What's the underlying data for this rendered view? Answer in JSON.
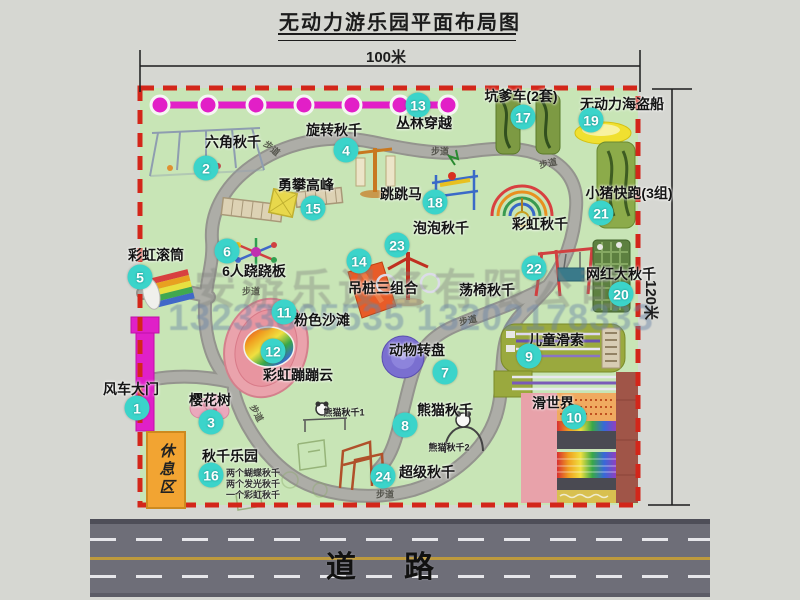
{
  "title": "无动力游乐园平面布局图",
  "dim_width": "100米",
  "dim_height": "120米",
  "road_label": "道路",
  "rest_area_label": "休息区",
  "path_label": "步道",
  "rainbow_swing_label": "彩虹秋千",
  "watermark": {
    "company": "安游乐设备有限公司",
    "phone": "13233805535 13202178333"
  },
  "attractions": [
    {
      "num": "1",
      "label": "风车大门"
    },
    {
      "num": "2",
      "label": "六角秋千"
    },
    {
      "num": "3",
      "label": "樱花树"
    },
    {
      "num": "4",
      "label": "旋转秋千"
    },
    {
      "num": "5",
      "label": "彩虹滚筒"
    },
    {
      "num": "6",
      "label": "6人跷跷板"
    },
    {
      "num": "7",
      "label": "动物转盘"
    },
    {
      "num": "8",
      "label": "熊猫秋千",
      "sub1": "熊猫秋千1",
      "sub2": "熊猫秋千2"
    },
    {
      "num": "9",
      "label": "儿童滑索"
    },
    {
      "num": "10",
      "label": "滑世界"
    },
    {
      "num": "11",
      "label": "粉色沙滩"
    },
    {
      "num": "12",
      "label": "彩虹蹦蹦云"
    },
    {
      "num": "13",
      "label": "丛林穿越"
    },
    {
      "num": "14",
      "label": "吊桩三组合"
    },
    {
      "num": "15",
      "label": "勇攀高峰"
    },
    {
      "num": "16",
      "label": "秋千乐园",
      "notes": [
        "两个蝴蝶秋千",
        "两个发光秋千",
        "一个彩虹秋千"
      ]
    },
    {
      "num": "17",
      "label": "坑爹车(2套)"
    },
    {
      "num": "18",
      "label": "跳跳马"
    },
    {
      "num": "19",
      "label": "无动力海盗船"
    },
    {
      "num": "20",
      "label": "网红大秋千"
    },
    {
      "num": "21",
      "label": "小猪快跑(3组)"
    },
    {
      "num": "22",
      "label": "荡椅秋千"
    },
    {
      "num": "23",
      "label": "泡泡秋千"
    },
    {
      "num": "24",
      "label": "超级秋千"
    }
  ]
}
